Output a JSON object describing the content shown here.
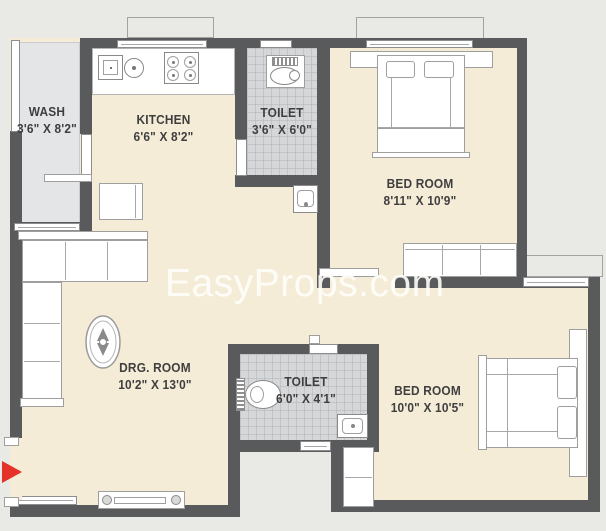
{
  "watermark": {
    "text": "EasyProps.com"
  },
  "colors": {
    "wall": "#595a5c",
    "floor": "#f5ecd8",
    "wash_floor": "#e3e5e7",
    "toilet_floor": "#d5d7d9",
    "outside": "#e9e9e6",
    "furniture": "#ffffff",
    "arrow_red": "#e53228",
    "label_text": "#3e3e3e"
  },
  "rooms": {
    "wash": {
      "name": "WASH",
      "dims": "3'6\" X 8'2\""
    },
    "kitchen": {
      "name": "KITCHEN",
      "dims": "6'6\" X 8'2\""
    },
    "toilet1": {
      "name": "TOILET",
      "dims": "3'6\" X 6'0\""
    },
    "bedroom1": {
      "name": "BED ROOM",
      "dims": "8'11\" X 10'9\""
    },
    "drawing_room": {
      "name": "DRG. ROOM",
      "dims": "10'2\" X 13'0\""
    },
    "toilet2": {
      "name": "TOILET",
      "dims": "6'0\" X 4'1\""
    },
    "bedroom2": {
      "name": "BED ROOM",
      "dims": "10'0\" X 10'5\""
    }
  }
}
